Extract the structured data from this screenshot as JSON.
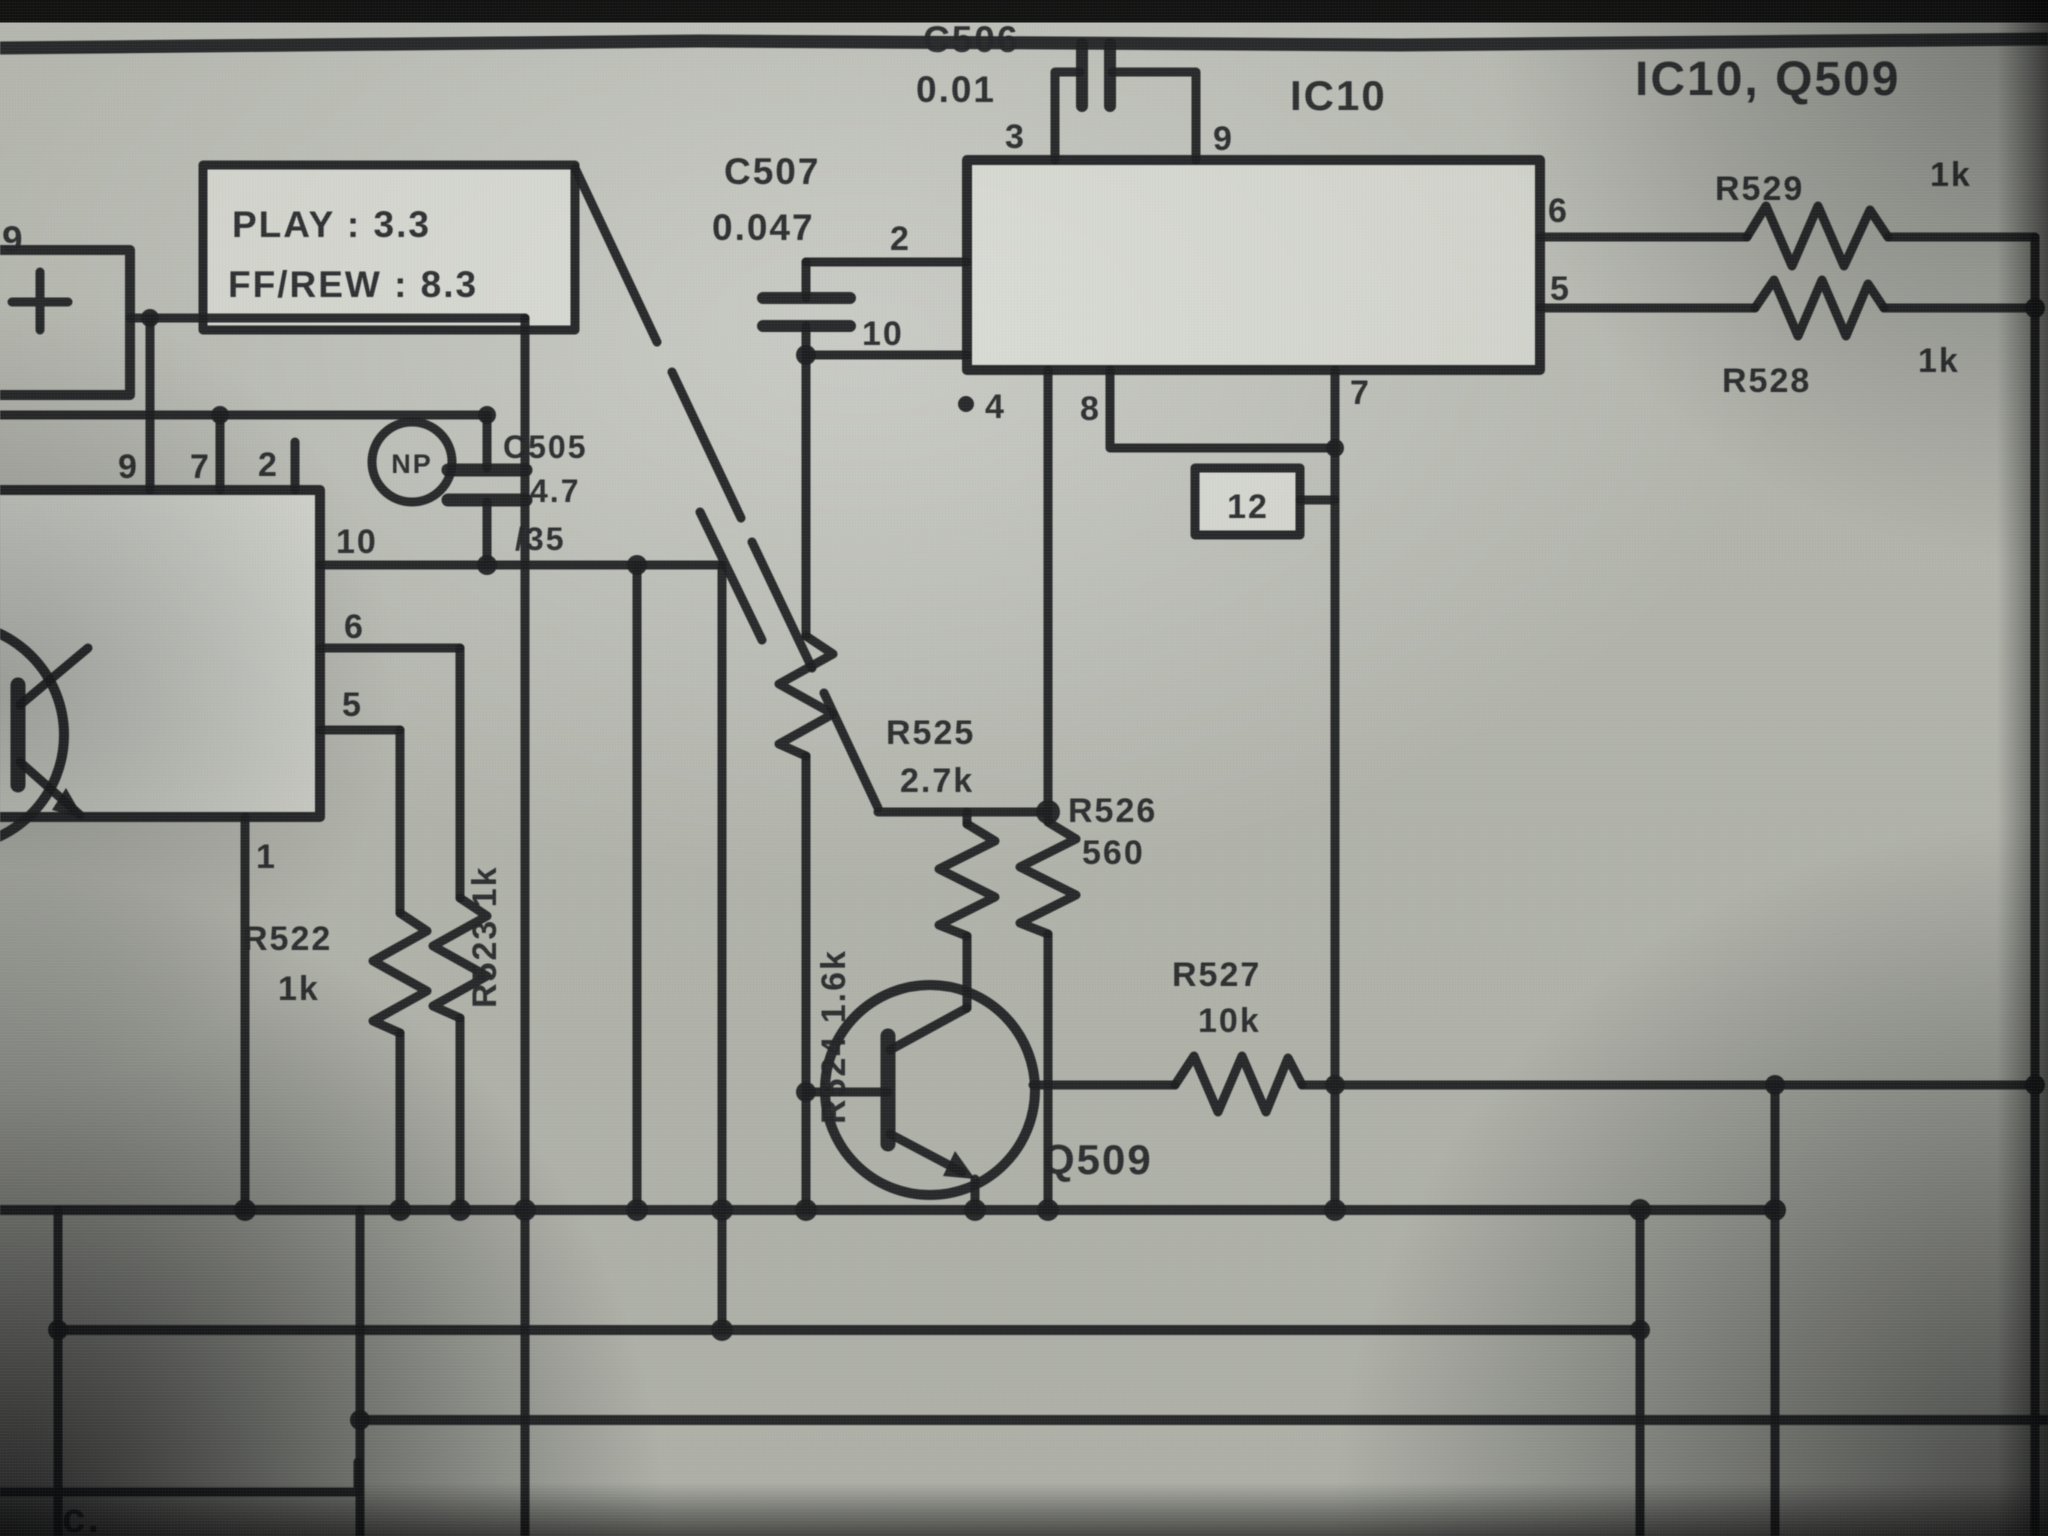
{
  "photo_note_top_right": "IC10, Q509",
  "annotation_box": {
    "line1": "PLAY : 3.3",
    "line2": "FF/REW : 8.3"
  },
  "labels": {
    "note": "IC10, Q509",
    "ic10": "IC10",
    "q509": "Q509",
    "box12": "12",
    "play1": "PLAY : 3.3",
    "play2": "FF/REW : 8.3",
    "c505_ref": "C505",
    "c505_val_num": "4.7",
    "c505_val_v": "/35",
    "c505_np": "NP",
    "c506_ref": "C506",
    "c506_val": "0.01",
    "c507_ref": "C507",
    "c507_val": "0.047",
    "r522_ref": "R522",
    "r522_val": "1k",
    "r523_rot": "R523 1k",
    "r524_rot": "R524 1.6k",
    "r525_ref": "R525",
    "r525_val": "2.7k",
    "r526_ref": "R526",
    "r526_val": "560",
    "r527_ref": "R527",
    "r527_val": "10k",
    "r528_ref": "R528",
    "r528_val": "1k",
    "r529_ref": "R529",
    "r529_val": "1k",
    "ic10_pin3": "3",
    "ic10_pin9": "9",
    "ic10_pin2": "2",
    "ic10_pin10": "10",
    "ic10_pin6": "6",
    "ic10_pin5": "5",
    "ic10_pin4": "4",
    "ic10_pin8": "8",
    "ic10_pin7": "7",
    "left_pin9_top": "9",
    "left_pin7_top": "7",
    "left_pin2_top": "2",
    "left_pin10": "10",
    "left_pin6": "6",
    "left_pin5": "5",
    "left_pin1": "1",
    "corner_pin9": "9",
    "corner_mark": "c."
  },
  "components": [
    {
      "ref": "IC10",
      "type": "ic",
      "pins_visible": [
        "3",
        "9",
        "2",
        "10",
        "6",
        "5",
        "4",
        "8",
        "7",
        "12"
      ]
    },
    {
      "ref": "Q509",
      "type": "transistor"
    },
    {
      "ref": "C505",
      "value": "4.7/35",
      "marking": "NP",
      "type": "capacitor"
    },
    {
      "ref": "C506",
      "value": "0.01",
      "type": "capacitor"
    },
    {
      "ref": "C507",
      "value": "0.047",
      "type": "capacitor"
    },
    {
      "ref": "R522",
      "value": "1k",
      "type": "resistor"
    },
    {
      "ref": "R523",
      "value": "1k",
      "type": "resistor"
    },
    {
      "ref": "R524",
      "value": "1.6k",
      "type": "resistor"
    },
    {
      "ref": "R525",
      "value": "2.7k",
      "type": "resistor"
    },
    {
      "ref": "R526",
      "value": "560",
      "type": "resistor"
    },
    {
      "ref": "R527",
      "value": "10k",
      "type": "resistor"
    },
    {
      "ref": "R528",
      "value": "1k",
      "type": "resistor"
    },
    {
      "ref": "R529",
      "value": "1k",
      "type": "resistor"
    }
  ],
  "left_ic_pins_visible": [
    "9",
    "7",
    "2",
    "10",
    "6",
    "5",
    "1"
  ]
}
